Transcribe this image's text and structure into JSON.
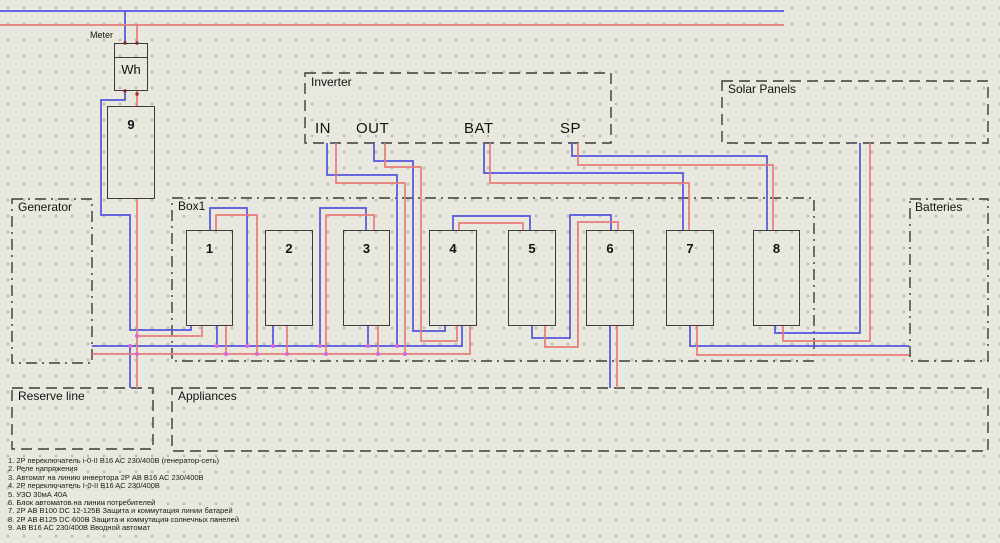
{
  "colors": {
    "bg": "#e9e8df",
    "grid-dot": "#b5b4aa",
    "wire-neutral": "#5454e0",
    "wire-live": "#ea7a7a",
    "junction": "#d966d9",
    "border": "#3b3b3b"
  },
  "regions": {
    "generator": "Generator",
    "box1": "Box1",
    "inverter": "Inverter",
    "solar_panels": "Solar Panels",
    "batteries": "Batteries",
    "reserve_line": "Reserve line",
    "appliances": "Appliances"
  },
  "meter": {
    "label": "Meter",
    "unit": "Wh"
  },
  "components": {
    "main_breaker_label": "9",
    "items": [
      "1",
      "2",
      "3",
      "4",
      "5",
      "6",
      "7",
      "8"
    ]
  },
  "inverter": {
    "terminals": [
      "IN",
      "OUT",
      "BAT",
      "SP"
    ]
  },
  "legend": {
    "items": [
      "1. 2P переключатель i-0-II B16 AC 230/400В (генератор-сеть)",
      "2. Реле напряжения",
      "3. Автомат на линию инвертора 2P АВ B16 AC 230/400В",
      "4. 2P переключатель I-0-II B16 AC 230/400В",
      "5. УЗО 30мА 40А",
      "6. Блок автоматов на линии потребителей",
      "7. 2P АВ B100 DC 12-125В Защита и коммутация линии батарей",
      "8. 2P АВ B125 DC 600В Защита и коммутация солнечных панелей",
      "9. АВ B16 AC 230/400В Вводной автомат"
    ]
  }
}
